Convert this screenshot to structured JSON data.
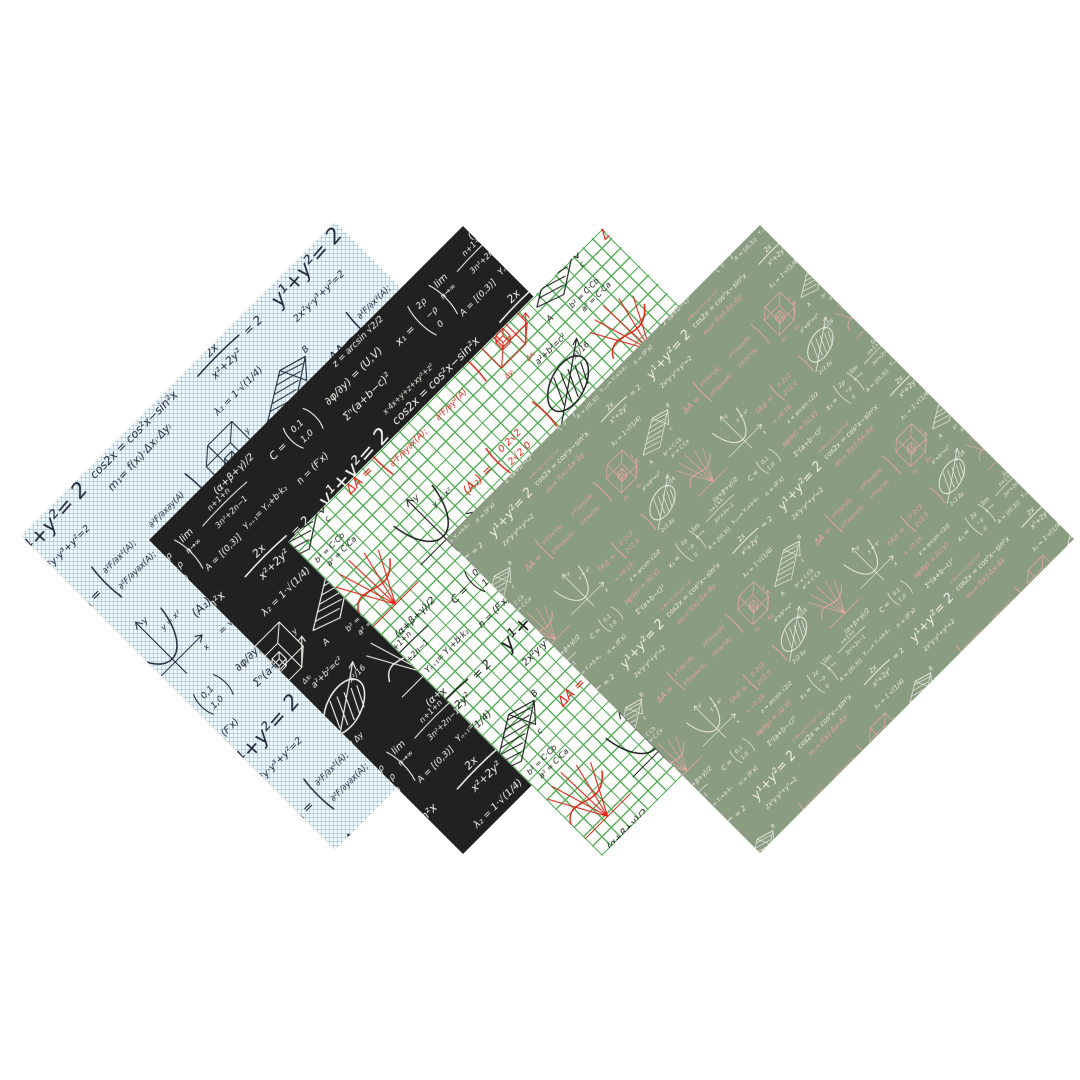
{
  "scene": {
    "background": "#ffffff",
    "description": "Four overlapping diamond (45°-rotated) swatches of a seamless hand-written math formula pattern in different colorways"
  },
  "swatches": [
    {
      "name": "blue-graph-paper",
      "colors": {
        "background": "#f5fafc",
        "grid": "#b0d4e6",
        "ink": "#222b3c",
        "accent": "#222b3c"
      },
      "grid_style": "fine-diagonal",
      "pattern_scale": 1
    },
    {
      "name": "black-chalkboard",
      "colors": {
        "background": "#212121",
        "grid": null,
        "ink": "#f4f4f2",
        "accent": "#efefe9"
      },
      "grid_style": "none",
      "pattern_scale": 1
    },
    {
      "name": "green-grid-red-ink",
      "colors": {
        "background": "#fdfefc",
        "grid": "#5aaf5f",
        "ink": "#1c1c1c",
        "accent": "#e12319"
      },
      "grid_style": "square",
      "pattern_scale": 1
    },
    {
      "name": "sage-chalk-pink",
      "colors": {
        "background": "#8a9c82",
        "grid": null,
        "ink": "#f1efe4",
        "accent": "#e9a7a1"
      },
      "grid_style": "none",
      "pattern_scale": 0.62
    }
  ],
  "pattern_motifs": {
    "circle_eq": "y¹+y²= 2",
    "top_eq": "2x²y·y³+y²=2",
    "double_angle": "cos2x = cos²x−sin²x",
    "edge_scribble": "x·4x+y+z+xy³+z²",
    "slope": "m₁= f(xᵢ)·Δxᵢ·Δyᵢ",
    "frac_num": "2x",
    "frac_den": "x²+2y²",
    "frac_rhs": "= 2",
    "lambda_eq": "λ₂ = 1·√(1/4)",
    "delta_label": "ΔA =",
    "m11": "∂²F/∂x²(A);",
    "m12": "∂²F/∂x∂y(A)",
    "m21": "∂²F/∂y∂x(A);",
    "m22": "∂²F/∂y²(A)",
    "cube_dx": "Δxᵢ",
    "cube_dy": "Δyᵢ",
    "axis_y": "y",
    "axis_x": "x",
    "prism_A": "A",
    "prism_B": "B",
    "prism_C": "c",
    "prism_b2": "b² = C·Cb",
    "prism_a2": "a² = C·Ca",
    "pythag": "a²+b²=c²",
    "parab_label": "y = x²",
    "a2_label": "(A₂) =",
    "a2_r1": "0   2√2",
    "a2_r2": "2√2   0",
    "sqrt_val": "= √0.16",
    "ellipse_frac": "x²/16",
    "ellipse_dy": "2√2 Δy",
    "c_label": "C =",
    "c_r1": "0,1",
    "c_r2": "1,0",
    "partial_uv": "∂φ/∂y) = (U,V)",
    "sum_sq": "Σⁿ(a+b−c)²",
    "vec_label": "x₁ =",
    "vec_r1": "2ρ",
    "vec_r2": "−ρ",
    "vec_r3": "0",
    "lim_word": "lim",
    "lim_sub": "n→∞",
    "lim_num": "n+1+n",
    "lim_den": "3n²+2n−1",
    "lhopital": "A = [(0,3)]",
    "alpha_eq": "(α+β+γ)/2",
    "y_next": "Yₙ₊₁= Yₙ+b·k₂",
    "normal_vec": "n = (F′x)",
    "arcsin_eq": "z = arcsin √2/2"
  }
}
